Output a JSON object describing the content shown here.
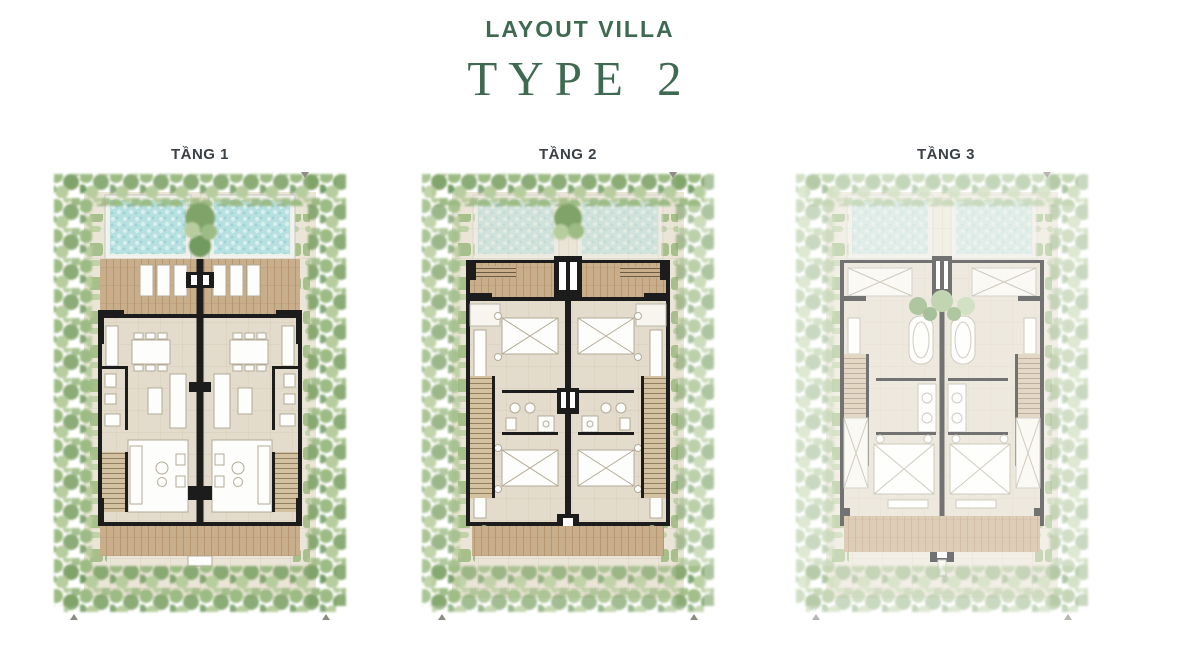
{
  "header": {
    "subtitle": "LAYOUT VILLA",
    "title": "TYPE 2"
  },
  "plans": [
    {
      "id": "tang-1",
      "label": "TẦNG 1"
    },
    {
      "id": "tang-2",
      "label": "TẦNG 2"
    },
    {
      "id": "tang-3",
      "label": "TẦNG 3"
    }
  ],
  "colors": {
    "green": "#3f6a52",
    "label": "#3b4045",
    "wall": "#1c1c1c",
    "pool": "#b7e0e1",
    "poolLight": "#d8efef",
    "poolDeep": "#9fd2d5",
    "wood": "#c9ae8c",
    "woodLine": "#b08f68",
    "floor": "#e3dbcb",
    "floorLine": "#d2c7b1",
    "path": "#ebe5d7",
    "pathLine": "#d9d1bf",
    "leaf1": "#9dbb84",
    "leaf2": "#7fa368",
    "leaf3": "#b7cd9e",
    "leaf4": "#6f9a5e",
    "hedge": "#a3bd87",
    "white": "#fdfdfb",
    "furnStroke": "#b3ab97",
    "stair": "#d4c1a0",
    "stairLine": "#807056"
  }
}
